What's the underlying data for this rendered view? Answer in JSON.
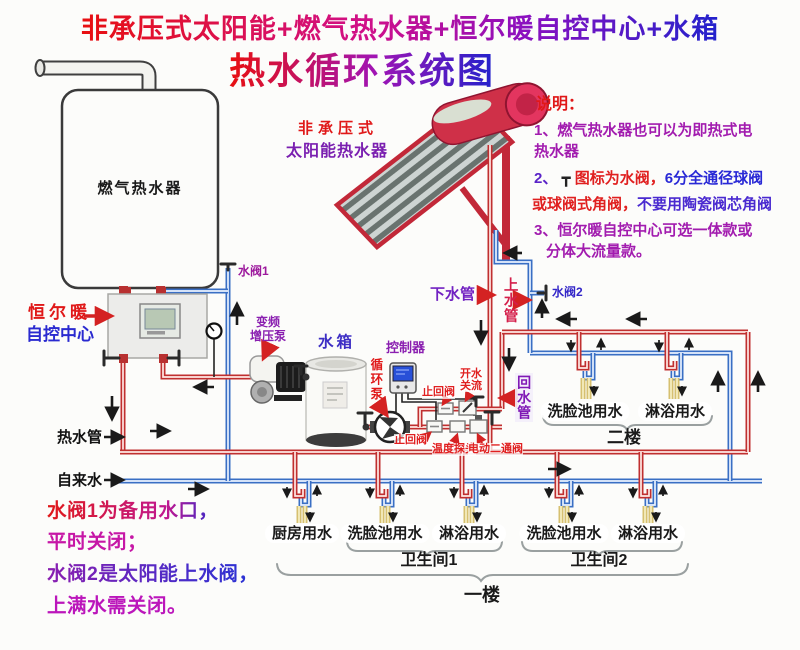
{
  "title": {
    "line1": "非承压式太阳能+燃气热水器+恒尔暖自控中心+水箱",
    "line2": "热水循环系统图"
  },
  "equipment": {
    "gas_heater": "燃气热水器",
    "control_center_line1": "恒尔暖",
    "control_center_line2": "自控中心",
    "solar_line1": "非承压式",
    "solar_line2": "太阳能热水器",
    "booster_pump_line1": "变频",
    "booster_pump_line2": "增压泵",
    "tank": "水箱",
    "controller": "控制器",
    "circ_pump": "循环泵"
  },
  "valves": {
    "valve1": "水阀1",
    "valve2": "水阀2",
    "check_valve_top": "止回阀",
    "check_valve_bottom": "止回阀",
    "open_close_line1": "开水",
    "open_close_line2": "关流",
    "temp_probe": "温度探头",
    "motor_valve": "电动二通阀"
  },
  "pipes": {
    "down_pipe": "下水管",
    "up_pipe": "上水管",
    "return_pipe": "回水管",
    "hot_pipe": "热水管",
    "tap_water": "自来水"
  },
  "floor2": {
    "outlets": [
      "洗脸池用水",
      "淋浴用水"
    ],
    "label": "二楼"
  },
  "floor1": {
    "outlets": [
      "厨房用水",
      "洗脸池用水",
      "淋浴用水",
      "洗脸池用水",
      "淋浴用水"
    ],
    "bathroom1": "卫生间1",
    "bathroom2": "卫生间2",
    "label": "一楼"
  },
  "legend": {
    "heading": "说明：",
    "note1_line1": "1、燃气热水器也可以为即热式电",
    "note1_line2": "热水器",
    "note2_num": "2、 ",
    "note2_icon": "┳ ",
    "note2_red": "图标为水阀，",
    "note2_blue": "6分全通径球阀",
    "note2b_red": "或球阀式角阀，",
    "note2b_blue": "不要用陶瓷阀芯角阀",
    "note3_line1": "3、恒尔暖自控中心可选一体款或",
    "note3_line2": "分体大流量款。"
  },
  "footnotes": {
    "line1": "水阀1为备用水口，",
    "line2": "平时关闭；",
    "line3": "水阀2是太阳能上水阀，",
    "line4": "上满水需关闭。"
  },
  "colors": {
    "pipe_hot": "#c03030",
    "pipe_cold": "#3a6fc4",
    "faucet_yellow": "#d6c070",
    "title_red": "#e81010",
    "title_blue": "#2222cc",
    "note_purple": "#a21caf",
    "label_red": "#e02020",
    "label_purple": "#8a1fb0",
    "label_blue": "#2a2ad0"
  }
}
